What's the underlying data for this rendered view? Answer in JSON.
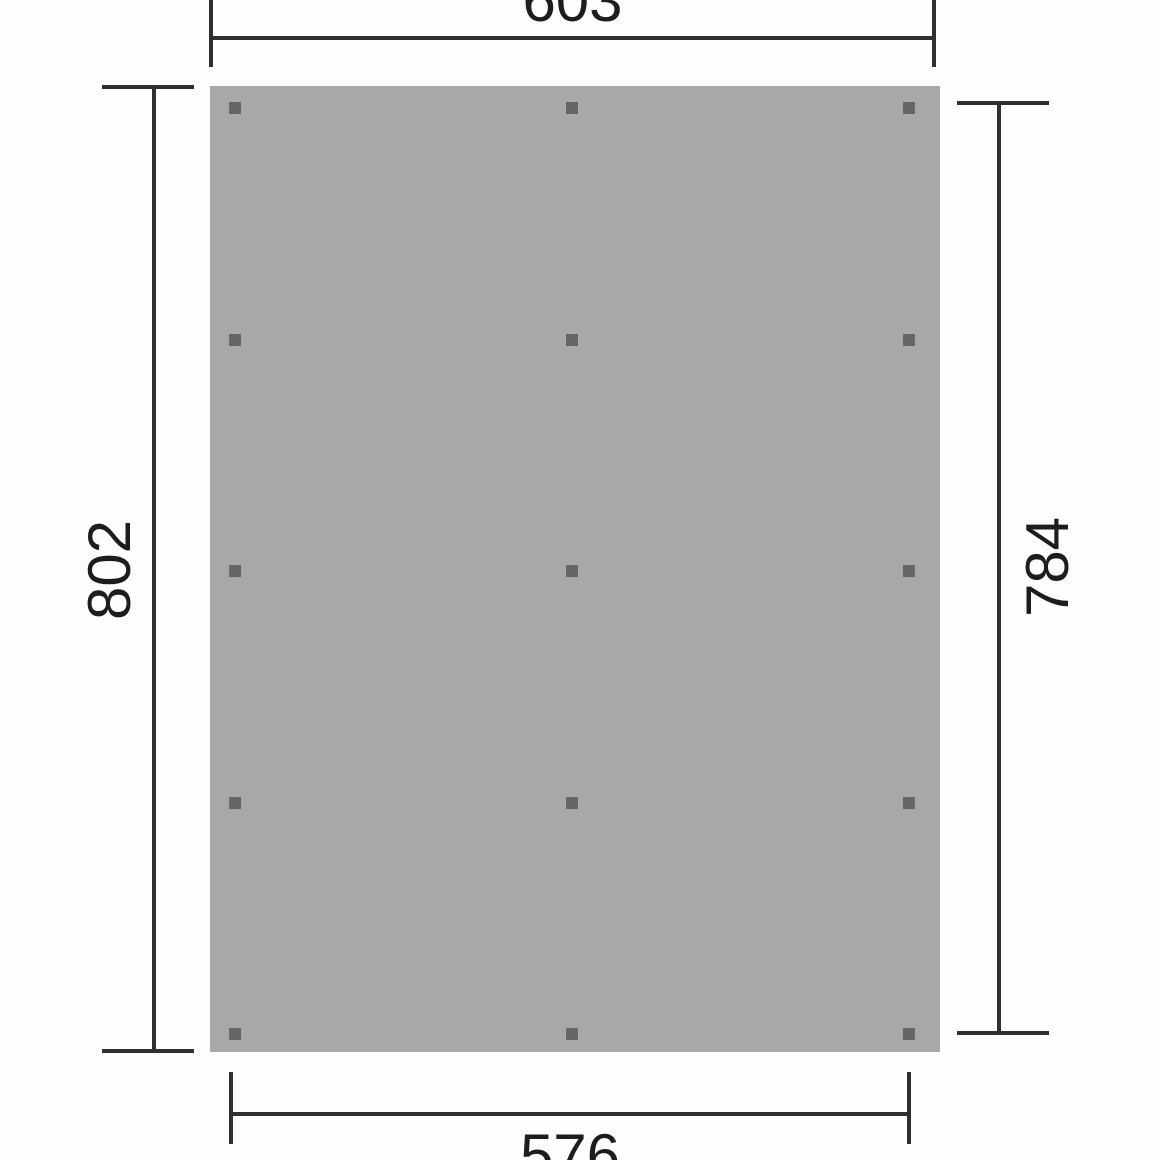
{
  "drawing": {
    "type": "plan-view-dimension-drawing",
    "panel": {
      "posts_columns": 3,
      "posts_rows": 5
    },
    "dimensions": {
      "top": {
        "value": "603"
      },
      "bottom": {
        "value": "576"
      },
      "left": {
        "value": "802"
      },
      "right": {
        "value": "784"
      }
    },
    "colors": {
      "background": "#fdfdfd",
      "panel": "#a7a8a9",
      "post": "#656667",
      "line": "#2f2f2f",
      "text": "#1d1d1d"
    }
  }
}
